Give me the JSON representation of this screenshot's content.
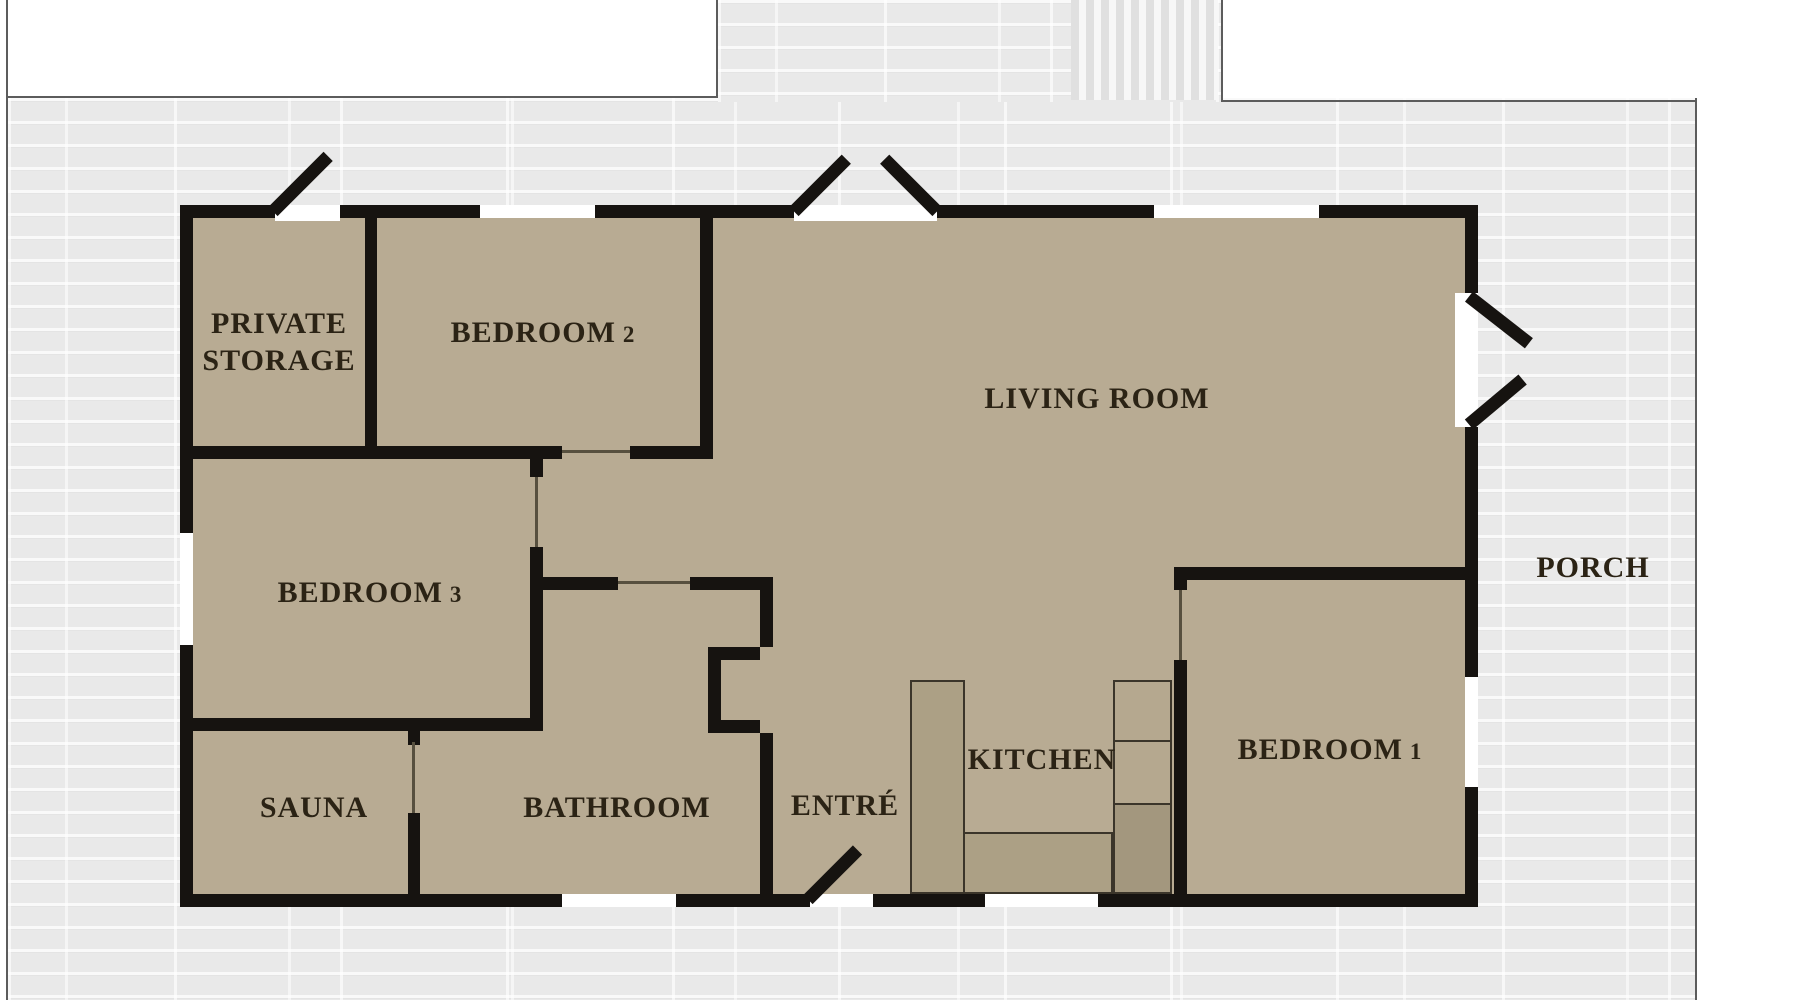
{
  "plan": {
    "rooms": {
      "private_storage": {
        "line1": "PRIVATE",
        "line2": "STORAGE"
      },
      "bedroom2": {
        "label": "BEDROOM",
        "num": "2"
      },
      "bedroom3": {
        "label": "BEDROOM",
        "num": "3"
      },
      "bedroom1": {
        "label": "BEDROOM",
        "num": "1"
      },
      "living_room": {
        "label": "LIVING ROOM"
      },
      "kitchen": {
        "label": "KITCHEN"
      },
      "bathroom": {
        "label": "BATHROOM"
      },
      "sauna": {
        "label": "SAUNA"
      },
      "entre": {
        "label": "ENTRÉ"
      },
      "porch": {
        "label": "PORCH"
      }
    },
    "colors": {
      "floor": "#b8ab93",
      "wall": "#161310",
      "brick_background": "#e9e9e9",
      "brick_mortar": "#f9f9f9",
      "window_white": "#ffffff",
      "counter": "#aca085",
      "counter_dark": "#a3977e",
      "label_text": "#2b2315"
    }
  }
}
